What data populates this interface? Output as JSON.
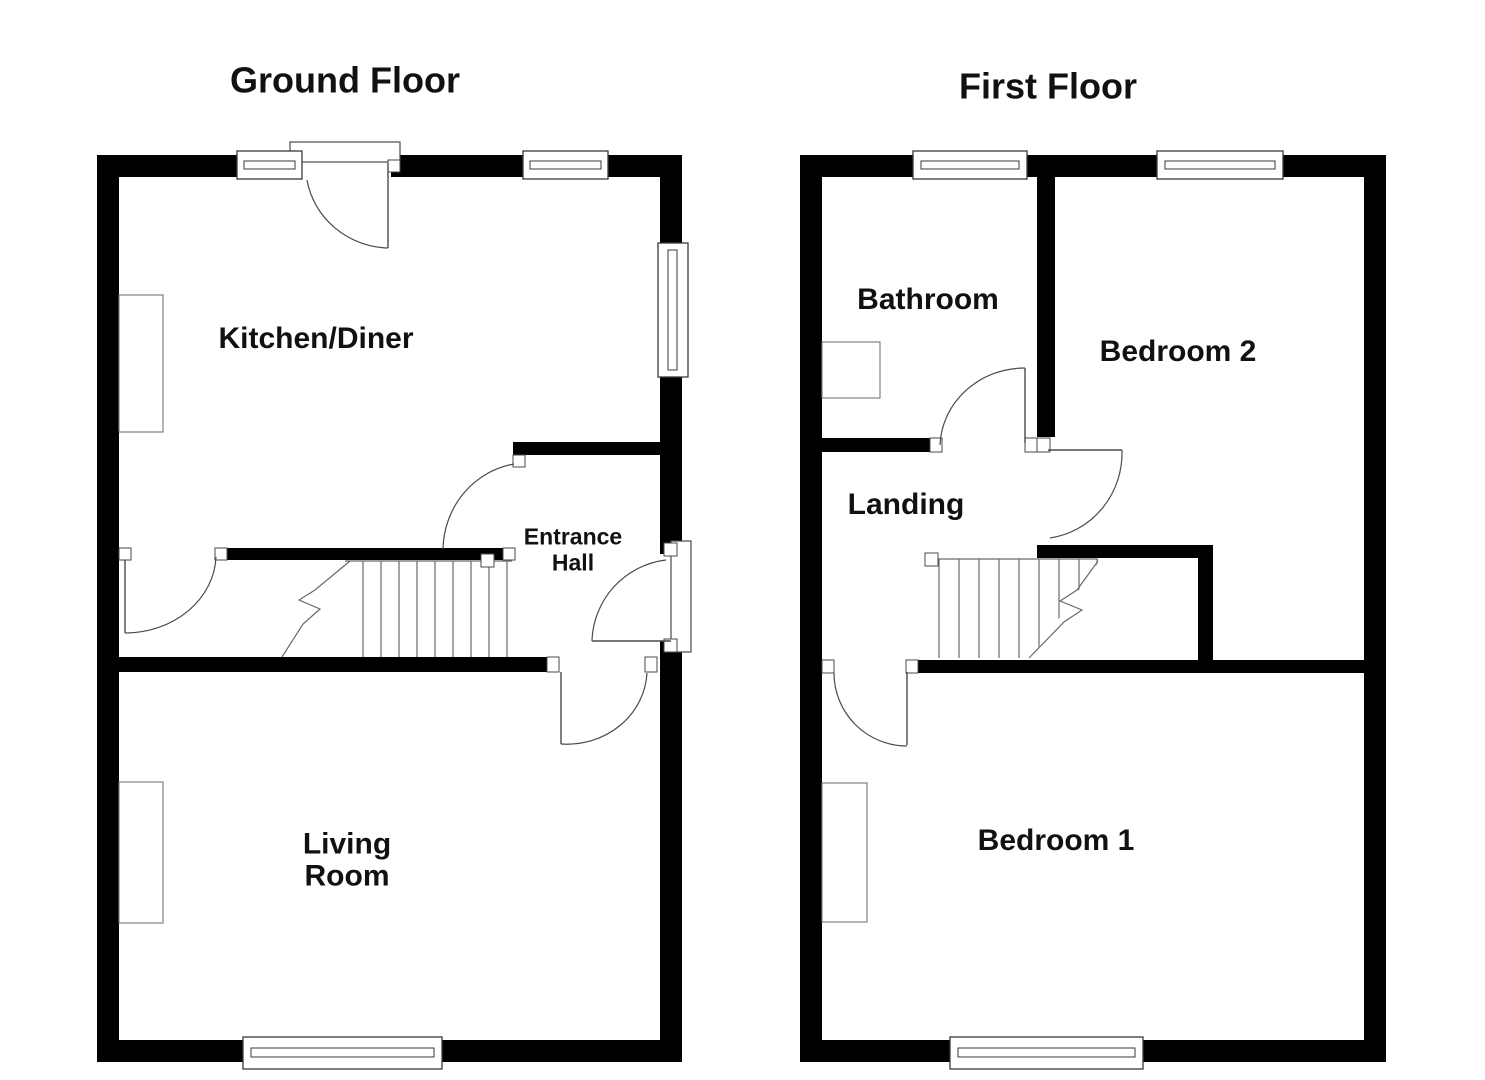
{
  "ground_floor": {
    "title": "Ground Floor",
    "kitchen_label": "Kitchen/Diner",
    "entrance_hall_label": "Entrance\nHall",
    "living_room_label": "Living\nRoom"
  },
  "first_floor": {
    "title": "First Floor",
    "bathroom_label": "Bathroom",
    "bedroom2_label": "Bedroom 2",
    "landing_label": "Landing",
    "bedroom1_label": "Bedroom 1"
  },
  "colors": {
    "wall": "#000000",
    "line": "#4a4a4a",
    "background": "#ffffff",
    "text": "#111111"
  }
}
